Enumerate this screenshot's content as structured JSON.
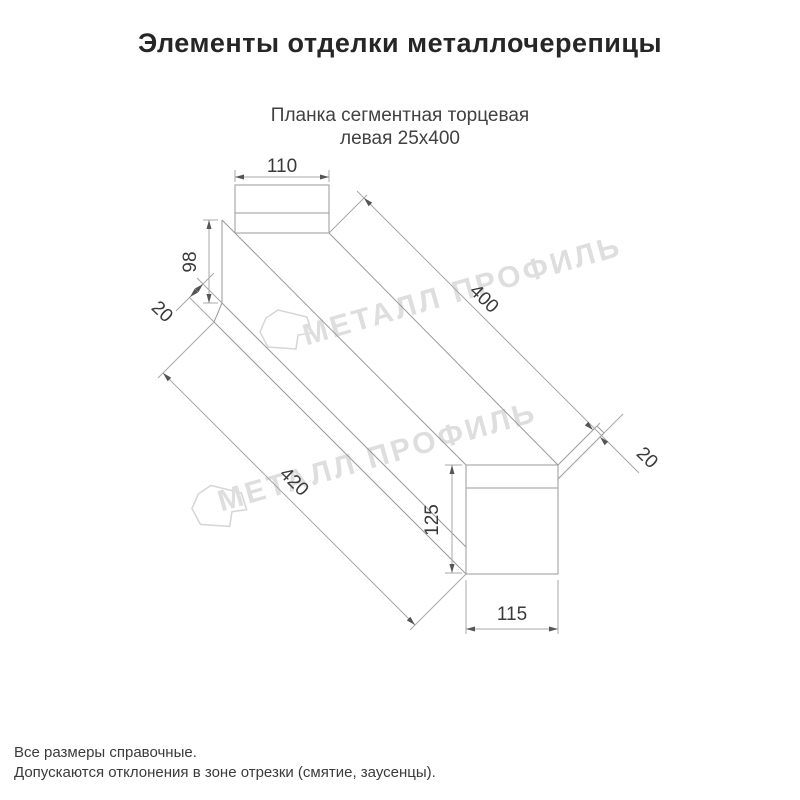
{
  "title": "Элементы отделки металлочерепицы",
  "subtitle": {
    "line1": "Планка сегментная торцевая",
    "line2": "левая 25х400"
  },
  "watermark": {
    "text": "МЕТАЛЛ ПРОФИЛЬ"
  },
  "dims": {
    "top_width": "110",
    "web_height": "98",
    "left_fold": "20",
    "top_length": "400",
    "right_fold": "20",
    "bottom_length": "420",
    "right_height": "125",
    "bottom_width": "115"
  },
  "footnotes": {
    "line1": "Все размеры справочные.",
    "line2": "Допускаются отклонения в зоне отрезки (смятие, заусенцы)."
  },
  "colors": {
    "background": "#ffffff",
    "title_text": "#262626",
    "subtitle_text": "#414141",
    "profile_line": "#9a9a9a",
    "dimension_line": "#a8a8a8",
    "dimension_text": "#3a3a3a",
    "watermark": "#dedede"
  }
}
